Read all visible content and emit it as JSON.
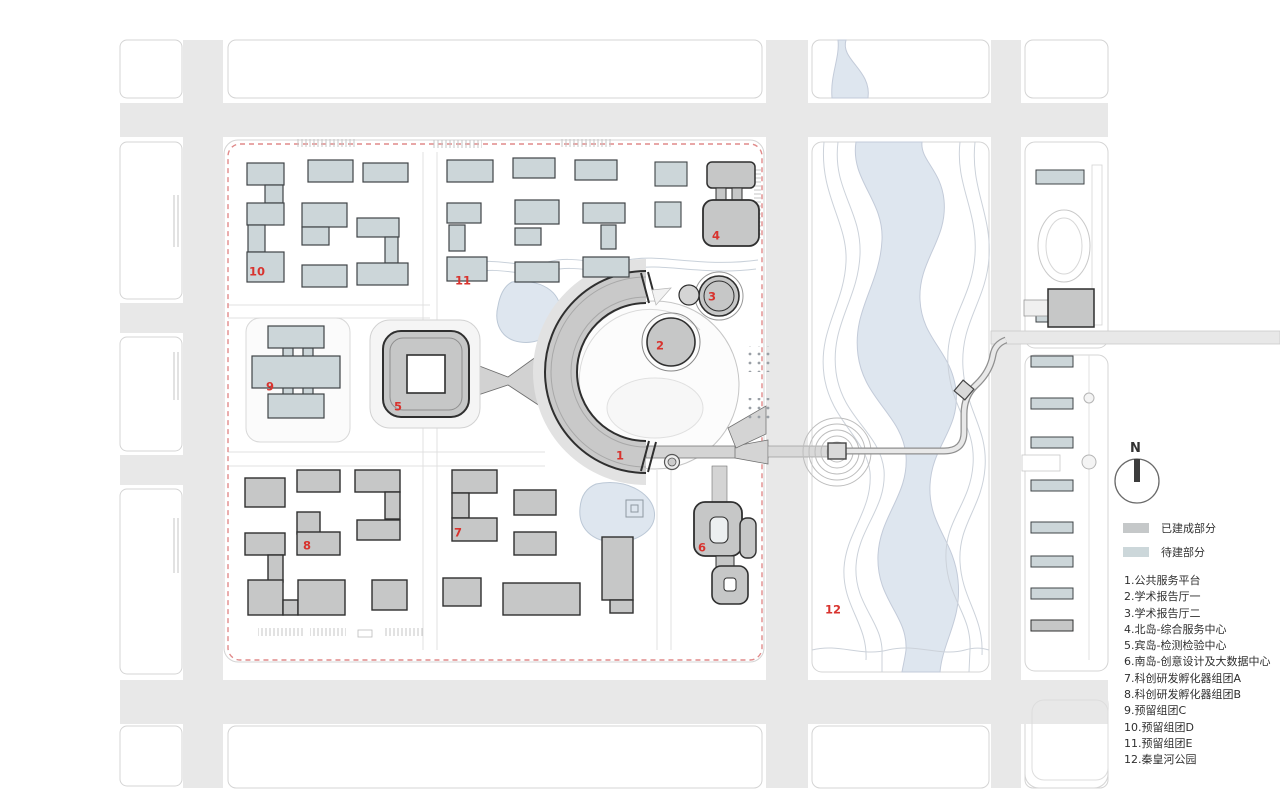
{
  "legend": {
    "north_label": "N",
    "built_label": "已建成部分",
    "planned_label": "待建部分",
    "items": [
      "1.公共服务平台",
      "2.学术报告厅一",
      "3.学术报告厅二",
      "4.北岛-综合服务中心",
      "5.宾岛-检测检验中心",
      "6.南岛-创意设计及大数据中心",
      "7.科创研发孵化器组团A",
      "8.科创研发孵化器组团B",
      "9.预留组团C",
      "10.预留组团D",
      "11.预留组团E",
      "12.秦皇河公园"
    ]
  },
  "markers": [
    "1",
    "2",
    "3",
    "4",
    "5",
    "6",
    "7",
    "8",
    "9",
    "10",
    "11",
    "12"
  ],
  "colors": {
    "built": "#c6c7c7",
    "planned": "#ccd6d9",
    "water": "#dee6ef",
    "road": "#e8e8e8",
    "marker_red": "#d8332e",
    "boundary_red": "#e08a8a"
  }
}
